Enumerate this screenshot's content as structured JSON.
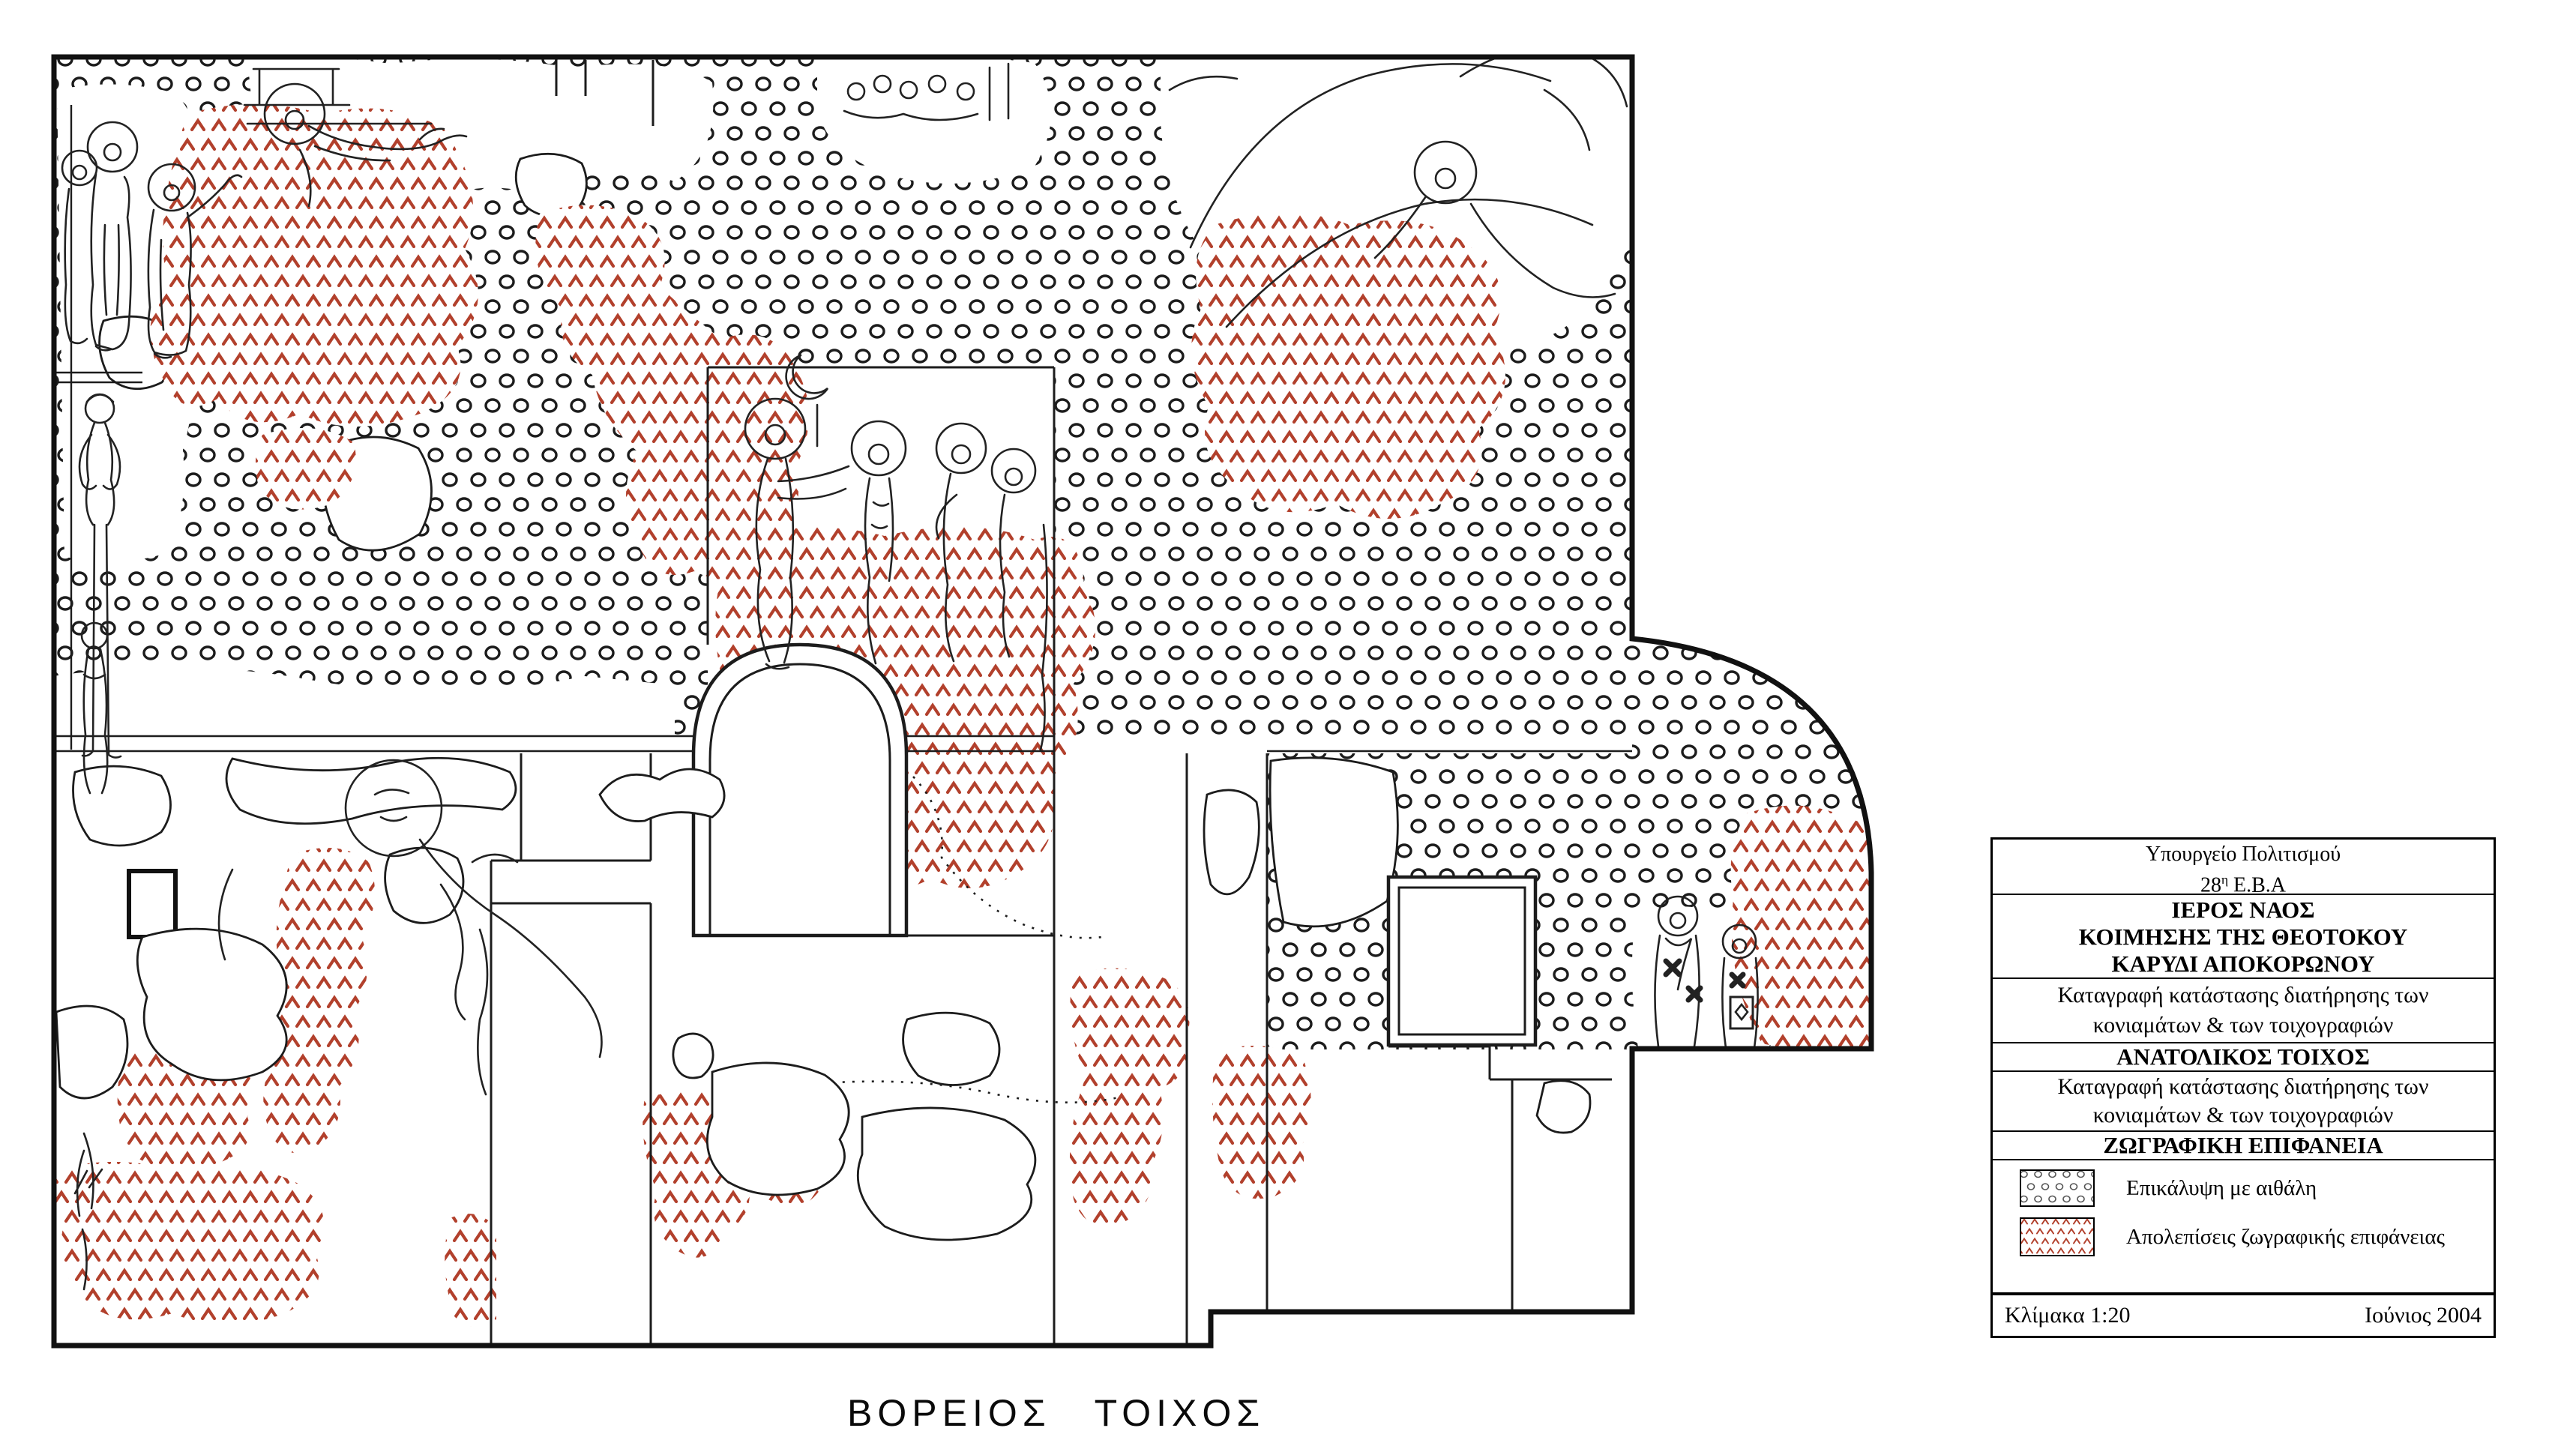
{
  "drawing": {
    "caption": "ΒΟΡΕΙΟΣ ΤΟΙΧΟΣ"
  },
  "title_block": {
    "ministry_line": "Υπουργείο Πολιτισμού",
    "ephorate_number": "28",
    "ephorate_sup": "η",
    "ephorate_rest": " Ε.Β.Α",
    "church_lines": [
      "ΙΕΡΟΣ ΝΑΟΣ",
      "ΚΟΙΜΗΣΗΣ ΤΗΣ ΘΕΟΤΟΚΟΥ",
      "ΚΑΡΥΔΙ ΑΠΟΚΟΡΩΝΟΥ"
    ],
    "survey1_line1": "Καταγραφή κατάστασης διατήρησης των",
    "survey1_line2": "κονιαμάτων & των τοιχογραφιών",
    "wall_heading": "ΑΝΑΤΟΛΙΚΟΣ ΤΟΙΧΟΣ",
    "survey2_line1": "Καταγραφή κατάστασης διατήρησης των",
    "survey2_line2": "κονιαμάτων & των τοιχογραφιών",
    "surface_heading": "ΖΩΓΡΑΦΙΚΗ ΕΠΙΦΑΝΕΙΑ",
    "legend": [
      {
        "swatch": "soot-circles-pattern",
        "label": "Επικάλυψη με αιθάλη"
      },
      {
        "swatch": "flaking-chevrons-pattern",
        "label": "Απολεπίσεις ζωγραφικής επιφάνειας"
      }
    ],
    "scale_label": "Κλίμακα 1:20",
    "date_label": "Ιούνιος 2004"
  },
  "colors": {
    "line_black": "#1c1c1c",
    "chevron_red": "#b2402c",
    "paper": "#ffffff"
  }
}
